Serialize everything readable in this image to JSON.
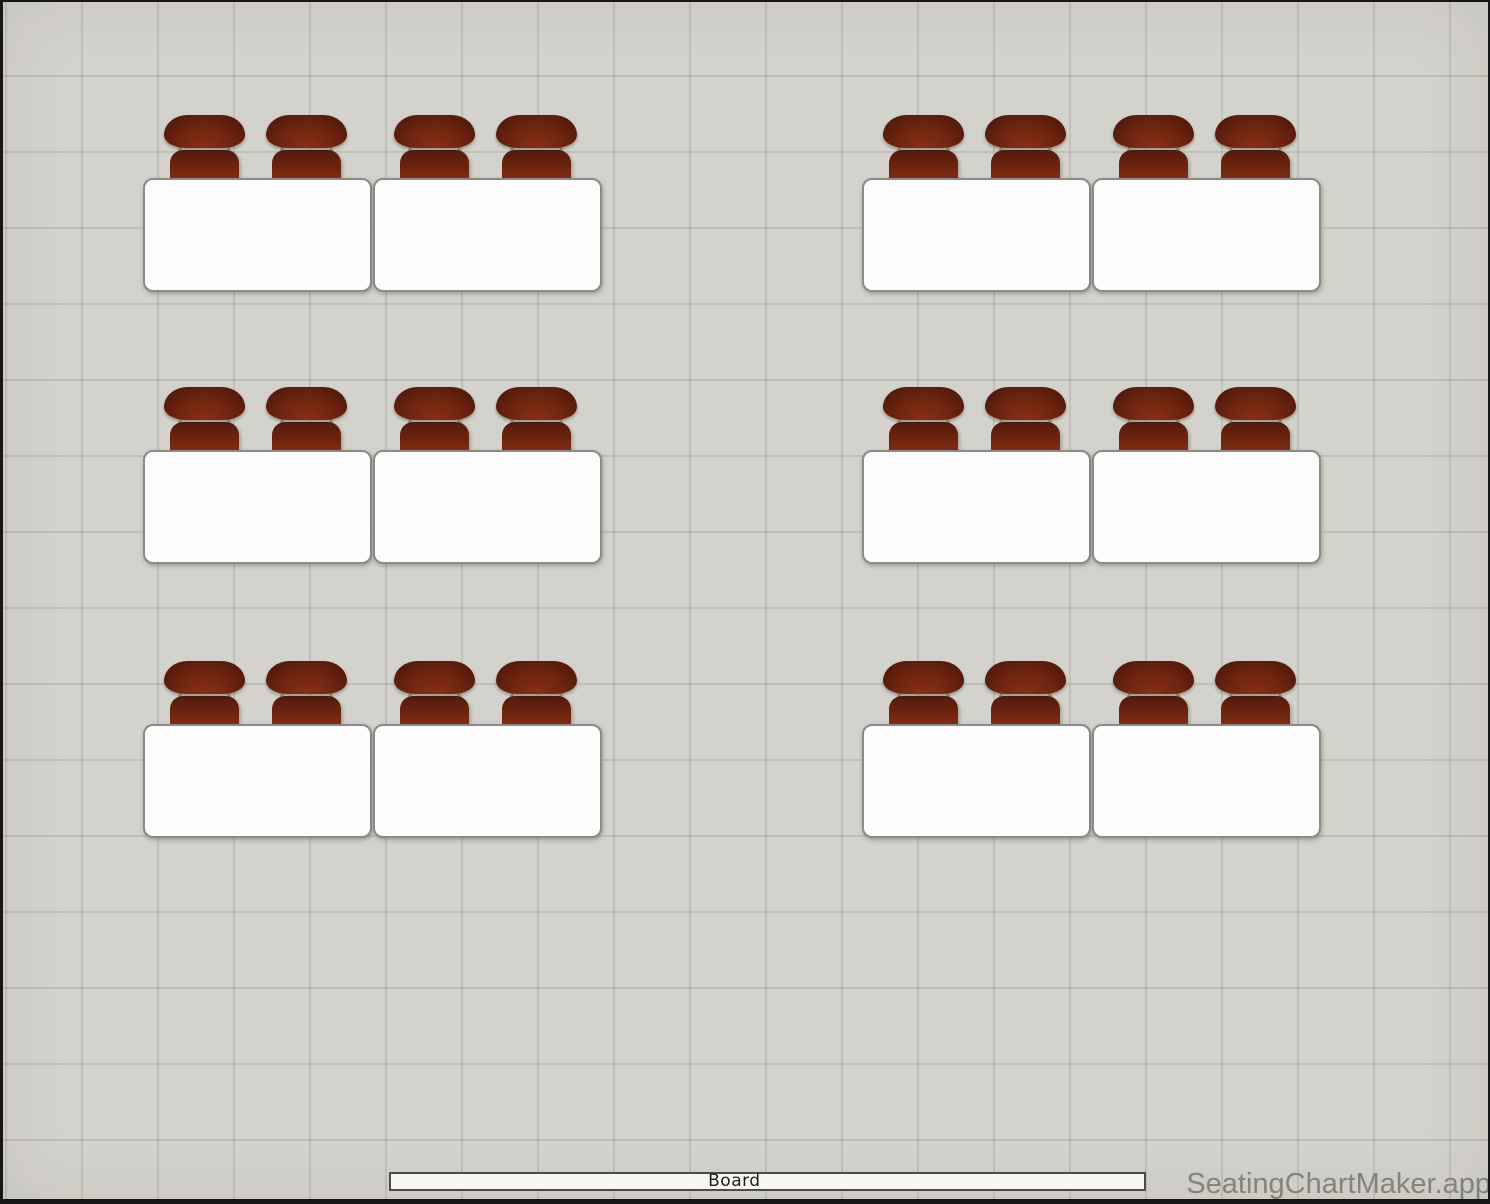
{
  "app": {
    "watermark_text": "SeatingChartMaker.app"
  },
  "board": {
    "label": "Board"
  },
  "theme": {
    "canvas_bg": "#d4d2cc",
    "grid_line": "#c6c4be",
    "desk_fill": "#fdfdfd",
    "desk_border": "#8a8a86",
    "chair_dark": "#45140a",
    "chair_mid": "#6f2510",
    "chair_light": "#8a3015",
    "seat_dark": "#531a0a",
    "seat_light": "#903418",
    "post_color": "#a09e98",
    "board_fill": "#f7f6f1",
    "board_border": "#4c4c4a",
    "watermark_color": "#85847c"
  },
  "layout_counts": {
    "desk_groups": 6,
    "desks": 12,
    "seats_total": 24
  },
  "desks": [
    {
      "x": 140,
      "y": 176,
      "seats": 2
    },
    {
      "x": 370,
      "y": 176,
      "seats": 2
    },
    {
      "x": 859,
      "y": 176,
      "seats": 2
    },
    {
      "x": 1089,
      "y": 176,
      "seats": 2
    },
    {
      "x": 140,
      "y": 448,
      "seats": 2
    },
    {
      "x": 370,
      "y": 448,
      "seats": 2
    },
    {
      "x": 859,
      "y": 448,
      "seats": 2
    },
    {
      "x": 1089,
      "y": 448,
      "seats": 2
    },
    {
      "x": 140,
      "y": 722,
      "seats": 2
    },
    {
      "x": 370,
      "y": 722,
      "seats": 2
    },
    {
      "x": 859,
      "y": 722,
      "seats": 2
    },
    {
      "x": 1089,
      "y": 722,
      "seats": 2
    }
  ],
  "chair_offsets": [
    21,
    123
  ]
}
